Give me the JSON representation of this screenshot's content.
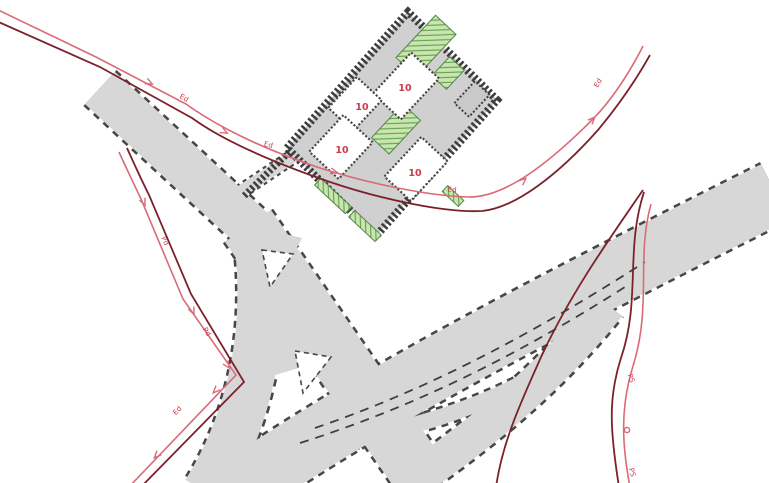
{
  "map": {
    "type": "site-utility-plan",
    "description_labels_visible_only": true
  },
  "colors": {
    "road_fill": "#d7d7d7",
    "road_edge": "#474747",
    "building_border": "#3d3d3d",
    "court_fill": "#d0d0d0",
    "building_fill": "#ffffff",
    "green_fill": "#c8e6b0",
    "green_hatch": "#69a152",
    "line_light_red": "#d96b78",
    "line_dark_red": "#7c212c",
    "label_red": "#cc3b4a"
  },
  "utility_labels": [
    {
      "text": "Ed"
    },
    {
      "text": "Ed"
    },
    {
      "text": "Ed"
    },
    {
      "text": "Ed"
    },
    {
      "text": "Pd"
    },
    {
      "text": "Pd"
    },
    {
      "text": "Ed"
    },
    {
      "text": "PS"
    },
    {
      "text": "PS"
    }
  ],
  "plot_numbers": [
    {
      "text": "10"
    },
    {
      "text": "10"
    },
    {
      "text": "10"
    },
    {
      "text": "10"
    }
  ]
}
